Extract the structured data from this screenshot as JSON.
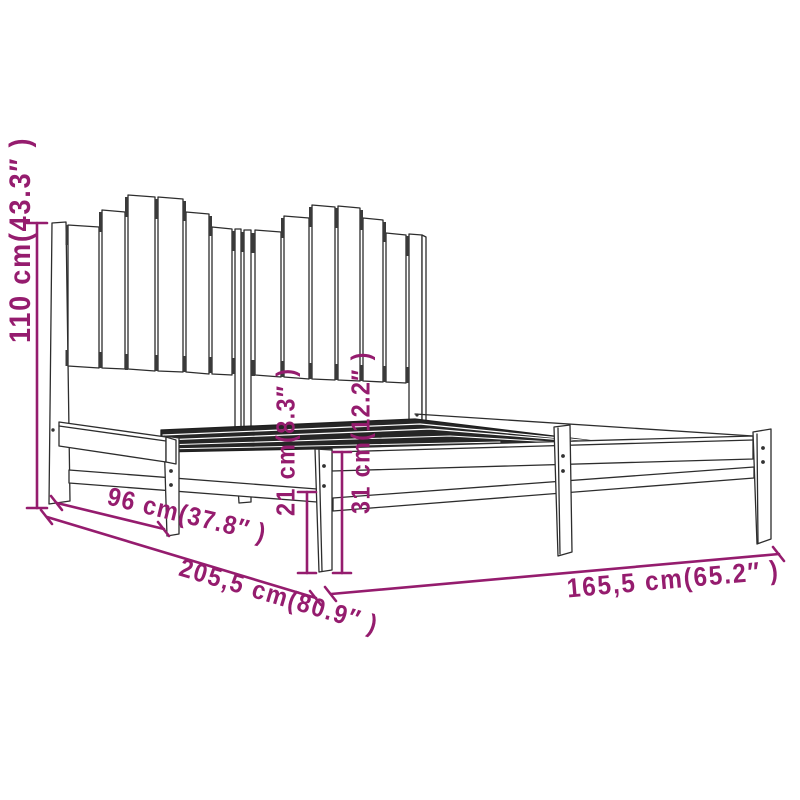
{
  "figure": {
    "name": "bed-frame-dimension-diagram",
    "subject": "wooden bed frame with plank headboard"
  },
  "dimension_labels": {
    "headboard_height": "110 cm(43.3″ )",
    "head_section_depth": "96 cm(37.8″ )",
    "total_length": "205,5 cm(80.9″ )",
    "under_bed_clearance": "21 cm(8.3″ )",
    "base_height": "31 cm(12.2″ )",
    "total_width": "165,5 cm(65.2″ )"
  },
  "colors": {
    "dimension_accent": "#951c6e",
    "line_art": "#2d2d2d",
    "background": "#ffffff"
  }
}
